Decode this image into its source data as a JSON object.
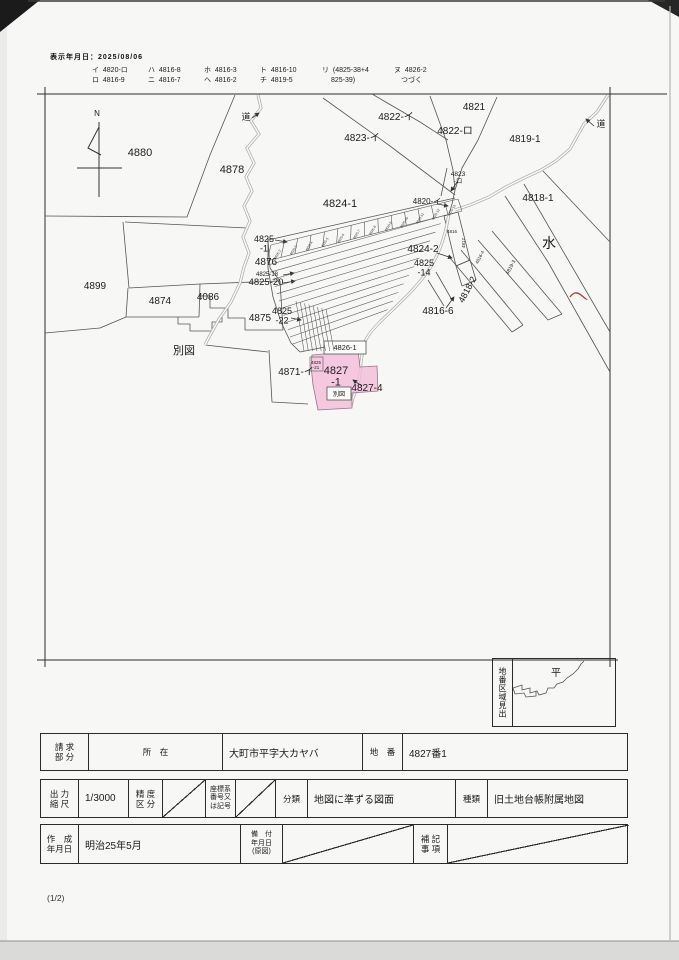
{
  "header": {
    "printed_date": "表示年月日：2025/08/06"
  },
  "legend": {
    "columns": [
      [
        "イ  4820-ロ",
        "ロ  4816-9"
      ],
      [
        "ハ  4816-8",
        "ニ  4816-7"
      ],
      [
        "ホ  4816-3",
        "ヘ  4816-2"
      ],
      [
        "ト  4816-10",
        "チ  4819-5"
      ],
      [
        "リ  (4825-38+4",
        "　 825-39)"
      ],
      [
        "ヌ  4826-2",
        "　つづく"
      ]
    ]
  },
  "map": {
    "highlight_color": "#f3bcda",
    "red_mark_color": "#b03a3a",
    "labels": [
      {
        "text": "N",
        "x": 97,
        "y": 116,
        "size": 8
      },
      {
        "text": "4880",
        "x": 140,
        "y": 156,
        "size": 11
      },
      {
        "text": "4878",
        "x": 232,
        "y": 173,
        "size": 11
      },
      {
        "text": "道",
        "x": 246,
        "y": 120,
        "size": 9
      },
      {
        "text": "4822-イ",
        "x": 396,
        "y": 120,
        "size": 10
      },
      {
        "text": "4823-イ",
        "x": 362,
        "y": 141,
        "size": 10
      },
      {
        "text": "4821",
        "x": 474,
        "y": 110,
        "size": 10
      },
      {
        "text": "4822-ロ",
        "x": 455,
        "y": 134,
        "size": 10
      },
      {
        "text": "4819-1",
        "x": 525,
        "y": 142,
        "size": 10
      },
      {
        "text": "道",
        "x": 601,
        "y": 127,
        "size": 9
      },
      {
        "text": "4823\n-ロ",
        "x": 458,
        "y": 176,
        "size": 6.5
      },
      {
        "text": "4820-イ",
        "x": 427,
        "y": 204,
        "size": 8
      },
      {
        "text": "4824-1",
        "x": 340,
        "y": 207,
        "size": 11
      },
      {
        "text": "4818-1",
        "x": 538,
        "y": 201,
        "size": 10
      },
      {
        "text": "水",
        "x": 549,
        "y": 248,
        "size": 14
      },
      {
        "text": "4824-2",
        "x": 423,
        "y": 252,
        "size": 10
      },
      {
        "text": "4825\n-14",
        "x": 424,
        "y": 266,
        "size": 9
      },
      {
        "text": "4825\n-1",
        "x": 264,
        "y": 242,
        "size": 9
      },
      {
        "text": "4876",
        "x": 266,
        "y": 265,
        "size": 10
      },
      {
        "text": "4825-18",
        "x": 267,
        "y": 276,
        "size": 6
      },
      {
        "text": "4825-20",
        "x": 266,
        "y": 285,
        "size": 9.5
      },
      {
        "text": "4816-6",
        "x": 438,
        "y": 314,
        "size": 10
      },
      {
        "text": "4818-2",
        "x": 470,
        "y": 291,
        "size": 9,
        "rot": -62
      },
      {
        "text": "4819-3",
        "x": 512,
        "y": 268,
        "size": 5,
        "rot": -62
      },
      {
        "text": "4816-4",
        "x": 481,
        "y": 258,
        "size": 4.5,
        "rot": -62
      },
      {
        "text": "4817",
        "x": 465,
        "y": 243,
        "size": 4.5,
        "rot": -90
      },
      {
        "text": "4816",
        "x": 452,
        "y": 233,
        "size": 4.5
      },
      {
        "text": "4899",
        "x": 95,
        "y": 289,
        "size": 10
      },
      {
        "text": "4874",
        "x": 160,
        "y": 304,
        "size": 10
      },
      {
        "text": "4086",
        "x": 208,
        "y": 300,
        "size": 10
      },
      {
        "text": "4875",
        "x": 260,
        "y": 321,
        "size": 10
      },
      {
        "text": "4825\n-22",
        "x": 282,
        "y": 314,
        "size": 9
      },
      {
        "text": "別図",
        "x": 184,
        "y": 354,
        "size": 11
      },
      {
        "text": "4826-1",
        "x": 345,
        "y": 350,
        "size": 7.5
      },
      {
        "text": "4871-イ",
        "x": 296,
        "y": 375,
        "size": 10
      },
      {
        "text": "4825\n-21",
        "x": 316,
        "y": 364,
        "size": 4.5
      },
      {
        "text": "4827\n-1",
        "x": 336,
        "y": 374,
        "size": 11
      },
      {
        "text": "4827-4",
        "x": 367,
        "y": 391,
        "size": 10
      },
      {
        "text": "別図",
        "x": 339,
        "y": 396,
        "size": 6
      }
    ],
    "strip_labels": [
      "4825-2",
      "4825-3",
      "4825-4",
      "4825-5",
      "4825-6",
      "4825-7",
      "4825-8",
      "4825-9",
      "4825-10",
      "4825-11",
      "4825-12",
      "4825-13"
    ]
  },
  "locator": {
    "title_vertical": "地番区域見出",
    "area_name": "平"
  },
  "table": {
    "request_label": "請 求\n部 分",
    "location_label": "所　在",
    "location_value": "大町市平字大カヤバ",
    "parcel_label": "地　番",
    "parcel_value": "4827番1",
    "scale_label": "出 力\n縮 尺",
    "scale_value": "1/3000",
    "precision_label": "精 度\n区 分",
    "coord_label": "座標系\n番号又\nは記号",
    "class_label": "分類",
    "class_value": "地図に準ずる図面",
    "kind_label": "種類",
    "kind_value": "旧土地台帳附属地図",
    "created_label": "作　成\n年月日",
    "created_value": "明治25年5月",
    "installed_label": "備　付\n年月日\n(原図)",
    "note_label": "補 記\n事 項"
  },
  "footer": {
    "page": "(1/2)"
  }
}
